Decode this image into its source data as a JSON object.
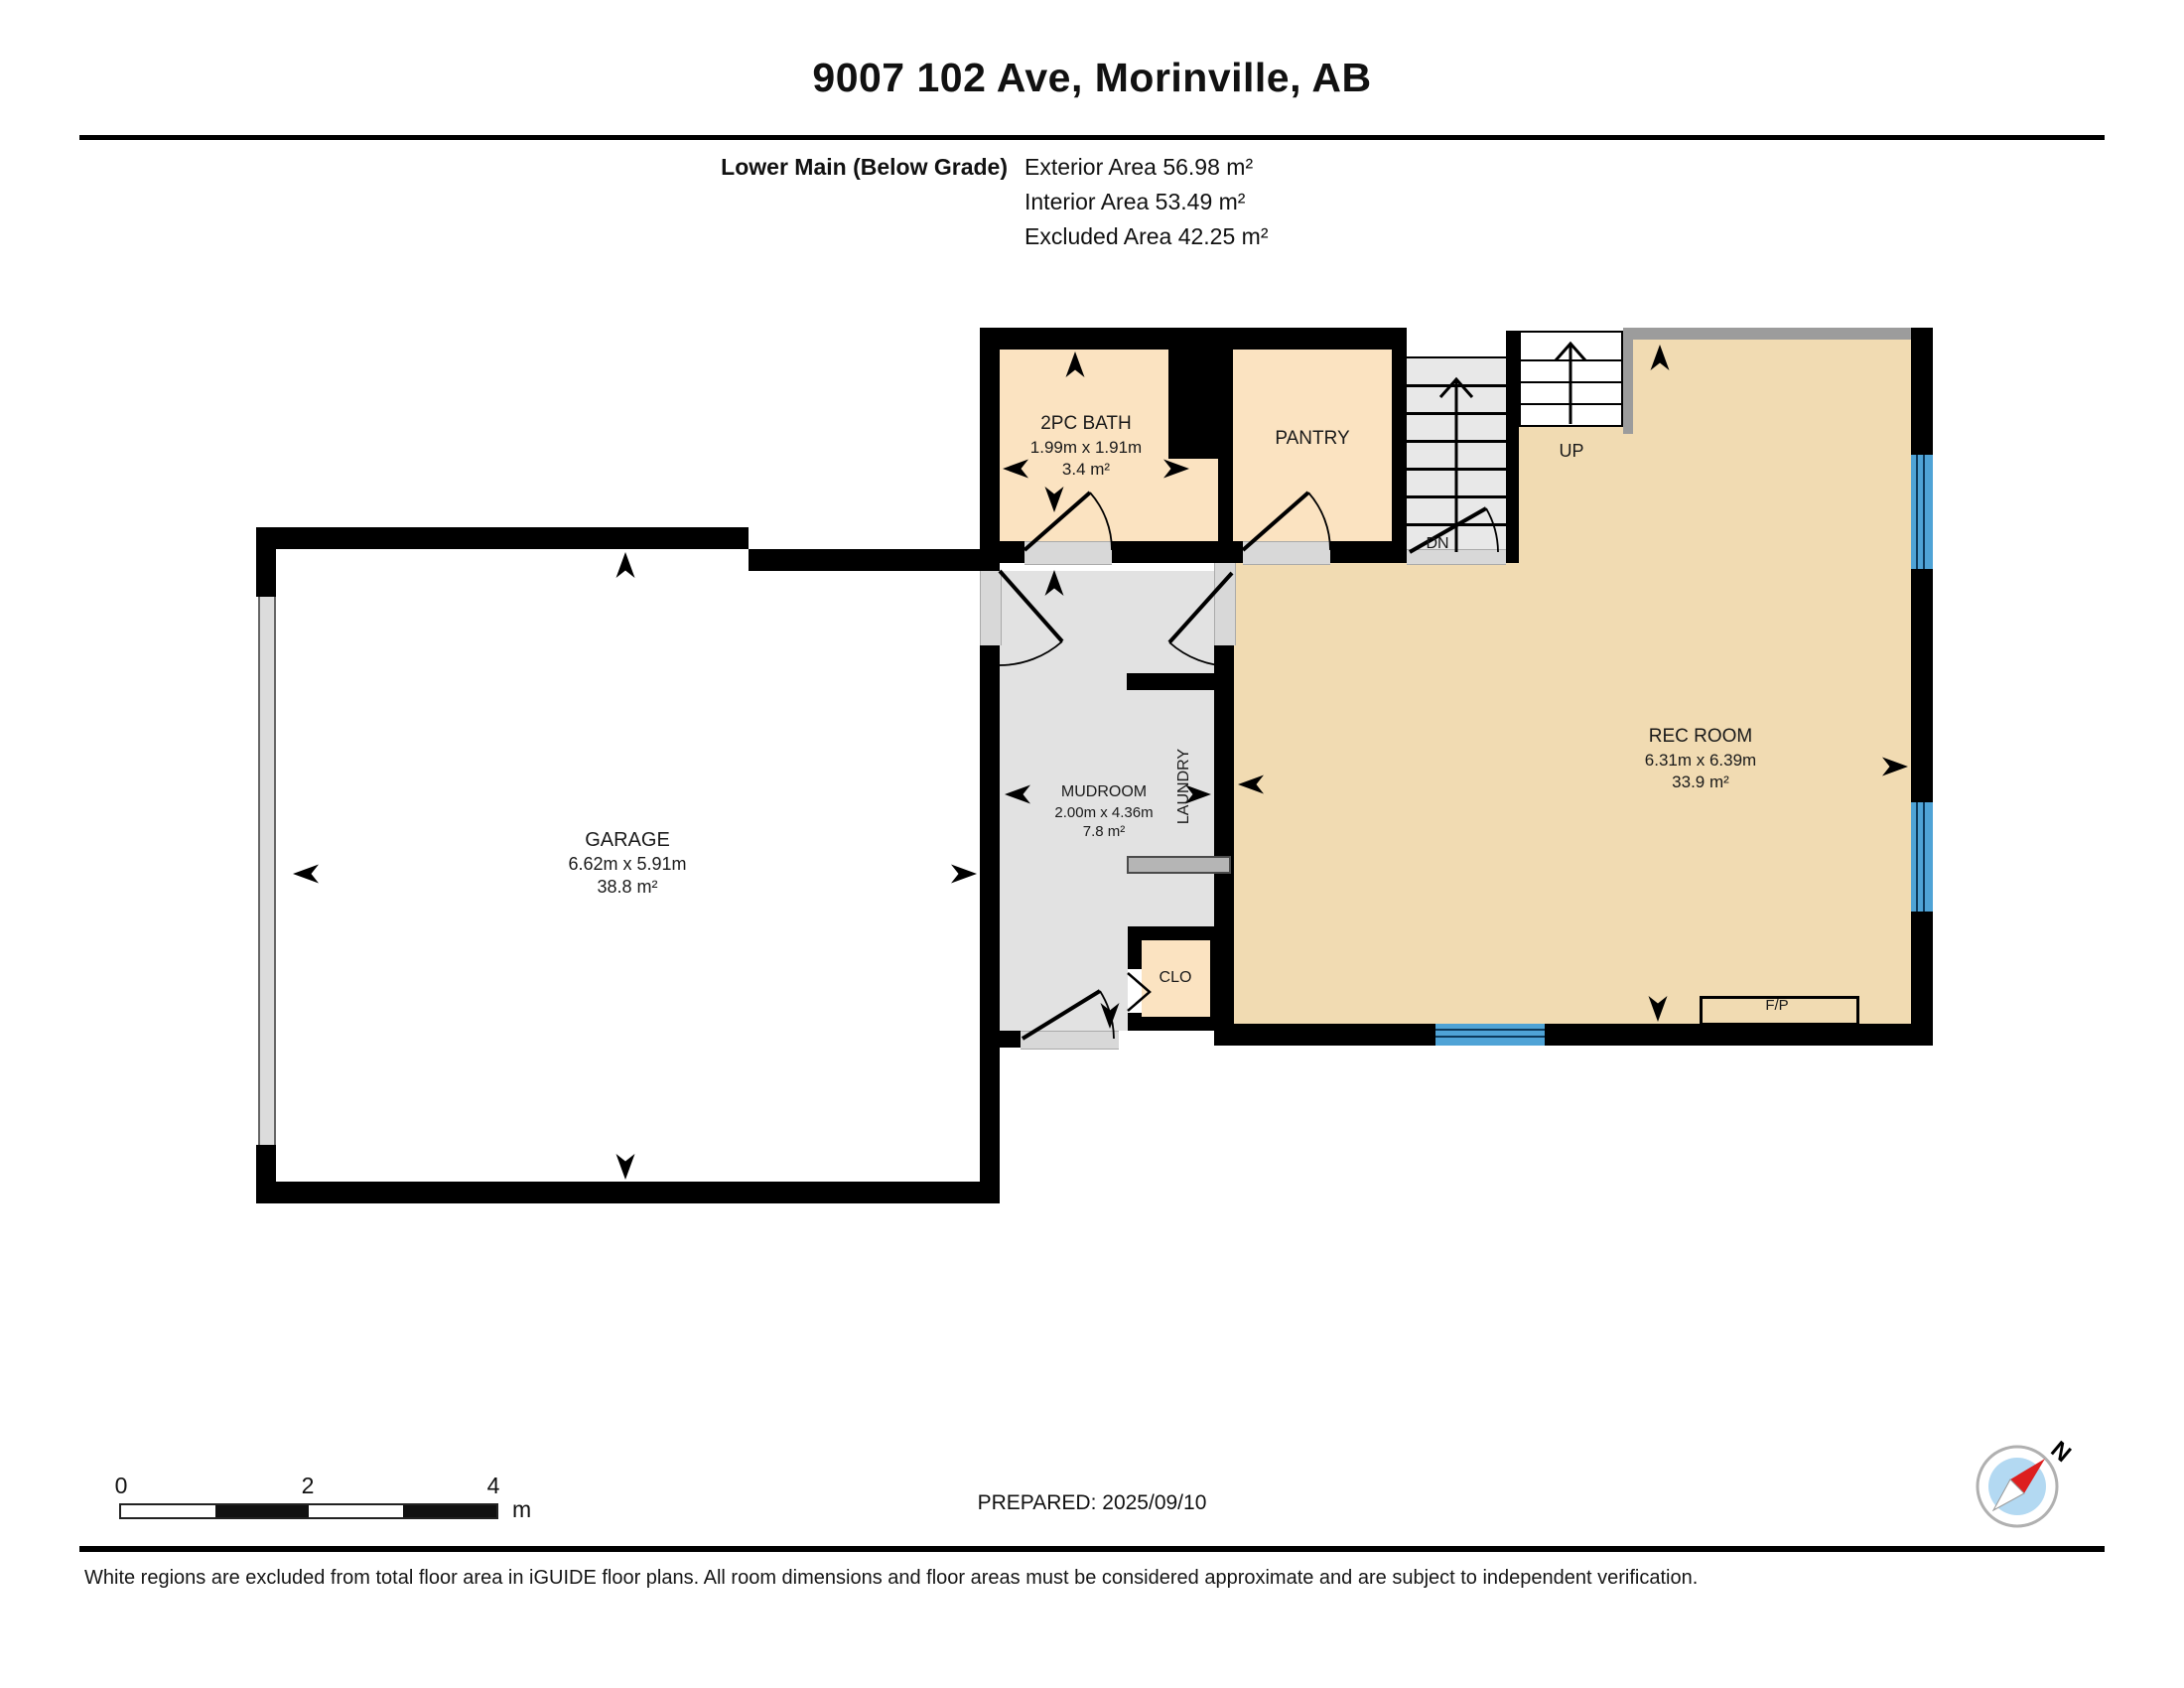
{
  "header": {
    "title": "9007 102 Ave, Morinville, AB"
  },
  "floor_info": {
    "floor_label": "Lower Main (Below Grade)",
    "exterior_area": "Exterior Area 56.98 m²",
    "interior_area": "Interior Area 53.49 m²",
    "excluded_area": "Excluded Area 42.25 m²"
  },
  "rooms": {
    "bath": {
      "name": "2PC BATH",
      "dims": "1.99m x 1.91m",
      "area": "3.4 m²"
    },
    "pantry": {
      "name": "PANTRY"
    },
    "stairs_up": {
      "label": "UP"
    },
    "stairs_dn": {
      "label": "DN"
    },
    "garage": {
      "name": "GARAGE",
      "dims": "6.62m x 5.91m",
      "area": "38.8 m²"
    },
    "mudroom": {
      "name": "MUDROOM",
      "dims": "2.00m x 4.36m",
      "area": "7.8 m²"
    },
    "laundry": {
      "label": "LAUNDRY"
    },
    "closet": {
      "label": "CLO"
    },
    "rec_room": {
      "name": "REC ROOM",
      "dims": "6.31m x 6.39m",
      "area": "33.9 m²"
    },
    "fireplace": {
      "label": "F/P"
    }
  },
  "scale_bar": {
    "tick0": "0",
    "tick2": "2",
    "tick4": "4",
    "unit": "m"
  },
  "prepared_label": "PREPARED: 2025/09/10",
  "compass": {
    "north_label": "N"
  },
  "footer": {
    "note": "White regions are excluded from total floor area in iGUIDE floor plans. All room dimensions and floor areas must be considered approximate and are subject to independent verification."
  },
  "colors": {
    "wall": "#000000",
    "room_warm": "#fbe3c1",
    "room_rec": "#f1dbb2",
    "room_gray": "#e2e2e2",
    "stair_gray": "#e8e8e8",
    "threshold": "#d8d8d8",
    "window_blue": "#4fa3d6",
    "rail_gray": "#9c9c9c",
    "counter_gray": "#b5b5b5",
    "compass_blue": "#b3d9f2",
    "compass_red": "#dd1f1f"
  }
}
